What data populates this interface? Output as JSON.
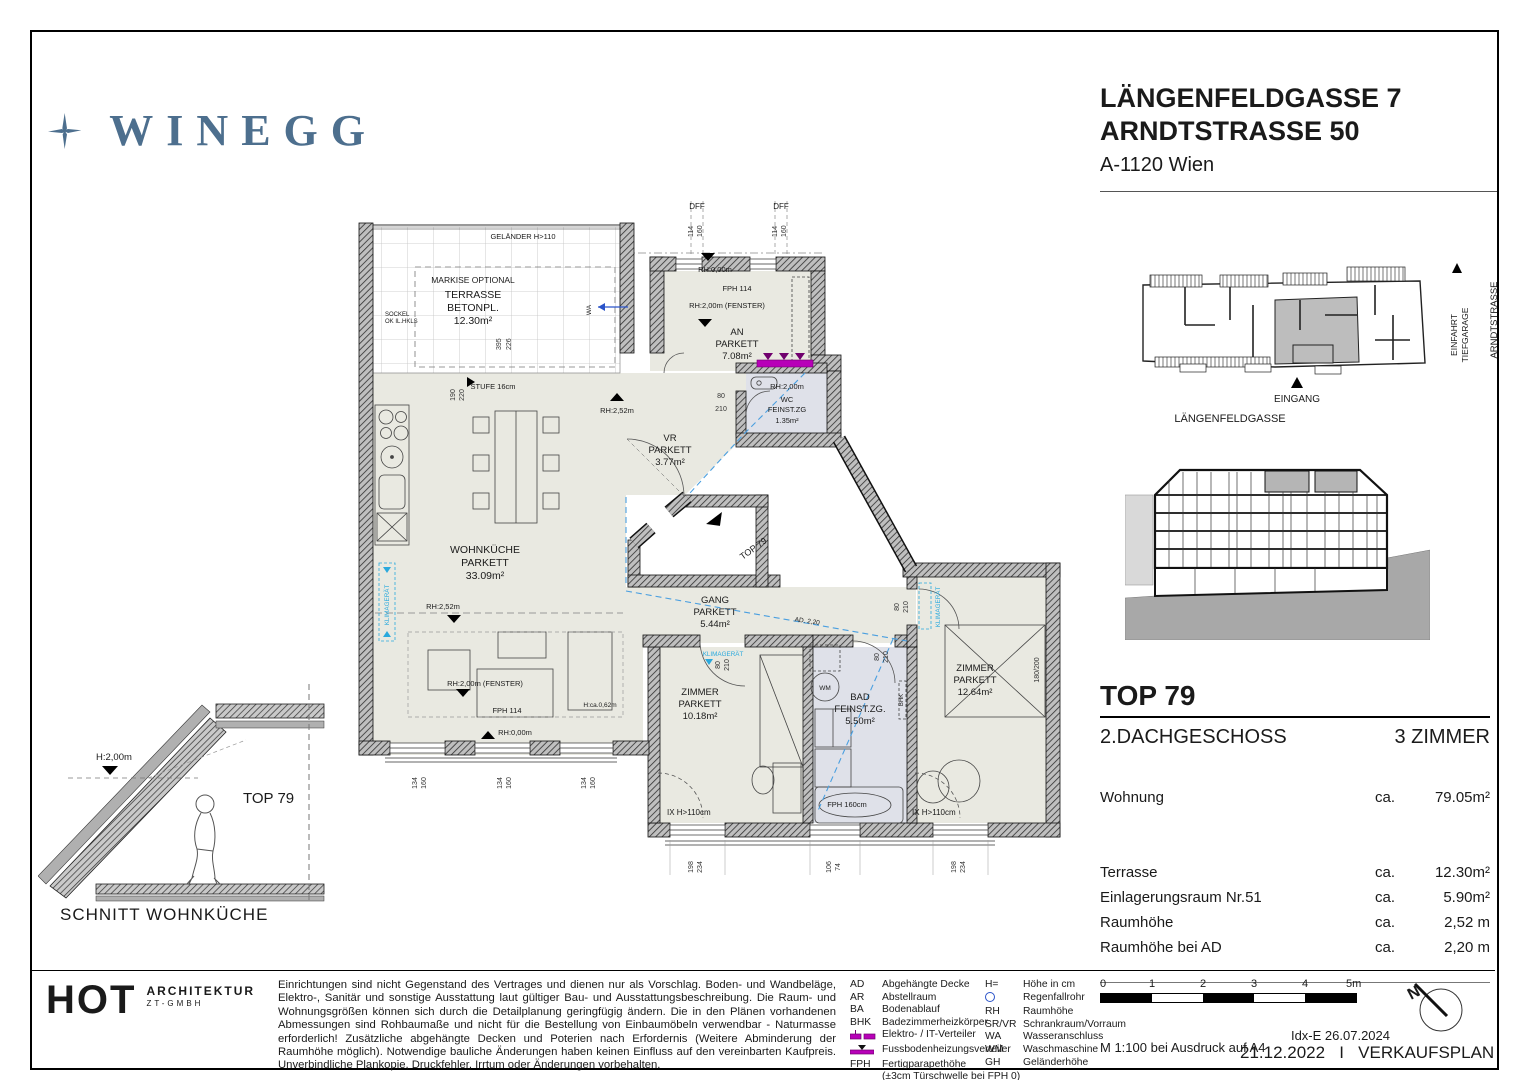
{
  "colors": {
    "brand": "#4d6f8e",
    "magenta": "#b800b8",
    "cyan": "#2aa9dd",
    "blue_dash": "#4a9fe0",
    "room": "#e9e9e1",
    "wet": "#dfe1e9",
    "wall_bg": "#bfbfbf",
    "grey": "#b0b0b0"
  },
  "brand": {
    "name": "WINEGG"
  },
  "address": {
    "line1": "LÄNGENFELDGASSE 7",
    "line2": "ARNDTSTRASSE 50",
    "city": "A-1120 Wien"
  },
  "site": {
    "eingang": "EINGANG",
    "street_bottom": "LÄNGENFELDGASSE",
    "einfahrt1": "EINFAHRT",
    "einfahrt2": "TIEFGARAGE",
    "street_right": "ARNDTSTRASSE"
  },
  "unit": {
    "top": "TOP 79",
    "floor": "2.DACHGESCHOSS",
    "rooms": "3 ZIMMER",
    "rows": [
      {
        "label": "Wohnung",
        "ca": "ca.",
        "value": "79.05m²"
      },
      {
        "label": "Terrasse",
        "ca": "ca.",
        "value": "12.30m²"
      },
      {
        "label": "Einlagerungsraum Nr.51",
        "ca": "ca.",
        "value": "5.90m²"
      },
      {
        "label": "Raumhöhe",
        "ca": "ca.",
        "value": "2,52 m"
      },
      {
        "label": "Raumhöhe bei AD",
        "ca": "ca.",
        "value": "2,20 m"
      }
    ]
  },
  "schnitt": {
    "h": "H:2,00m",
    "unit": "TOP 79",
    "caption": "SCHNITT WOHNKÜCHE"
  },
  "plan": {
    "gelaender": "GELÄNDER  H>110",
    "markise": "MARKISE  OPTIONAL",
    "terrasse1": "TERRASSE",
    "terrasse2": "BETONPL.",
    "terrasse3": "12.30m²",
    "sockel1": "SOCKEL",
    "sockel2": "OK  IL.HKLS",
    "stufe": "STUFE  16cm",
    "d190": "190",
    "d220": "220",
    "d395": "395",
    "d226": "226",
    "dff": "DFF",
    "d114": "114",
    "d160": "160",
    "rh000": "RH:0,00m",
    "fph114": "FPH  114",
    "rh200f": "RH:2,00m  (FENSTER)",
    "rh252": "RH:2,52m",
    "rh200": "RH:2,00m",
    "an1": "AN",
    "an2": "PARKETT",
    "an3": "7.08m²",
    "wa": "WA",
    "wc1": "WC",
    "wc2": "FEINST.ZG",
    "wc3": "1.35m²",
    "vr1": "VR",
    "vr2": "PARKETT",
    "vr3": "3.77m²",
    "top79": "TOP 79",
    "d80": "80",
    "d210": "210",
    "wk1": "WOHNKÜCHE",
    "wk2": "PARKETT",
    "wk3": "33.09m²",
    "gang1": "GANG",
    "gang2": "PARKETT",
    "gang3": "5.44m²",
    "ad220": "AD. 2,20",
    "klima": "KLIMAGERÄT",
    "z11": "ZIMMER",
    "z12": "PARKETT",
    "z13": "10.18m²",
    "bad1": "BAD",
    "bad2": "FEINST.ZG.",
    "bad3": "5.50m²",
    "wm": "WM",
    "bhk": "BHK",
    "fph160": "FPH  160cm",
    "z21": "ZIMMER",
    "z22": "PARKETT",
    "z23": "12.64m²",
    "d180200": "180/200",
    "hx": "IX  H>110cm",
    "d198": "198",
    "d234": "234",
    "d106": "106",
    "d74": "74",
    "d134": "134",
    "hca": "H:ca.0,62m"
  },
  "architect": {
    "logo": "HOT",
    "line1": "ARCHITEKTUR",
    "line2": "ZT-GMBH"
  },
  "disclaimer": "Einrichtungen sind nicht Gegenstand des Vertrages und dienen nur als Vorschlag. Boden- und Wandbeläge, Elektro-, Sanitär und sonstige Ausstattung laut gültiger Bau- und Ausstattungsbeschreibung. Die Raum- und Wohnungsgrößen können sich durch die Detailplanung geringfügig ändern. Die in den Plänen vorhandenen Abmessungen sind Rohbaumaße und nicht für die Bestellung von Einbaumöbeln verwendbar - Naturmasse erforderlich! Zusätzliche abgehängte Decken und Poterien nach Erfordernis (Weitere Abminderung der Raumhöhe möglich). Notwendige bauliche Änderungen haben keinen Einfluss auf den vereinbarten Kaufpreis. Unverbindliche Plankopie, Druckfehler, Irrtum oder Änderungen vorbehalten.",
  "legend": {
    "col1": [
      {
        "abbr": "AD",
        "desc": "Abgehängte Decke"
      },
      {
        "abbr": "AR",
        "desc": "Abstellraum"
      },
      {
        "abbr": "BA",
        "desc": "Bodenablauf"
      },
      {
        "abbr": "BHK",
        "desc": "Badezimmerheizkörper"
      },
      {
        "abbr": "",
        "desc": "Elektro- / IT-Verteiler",
        "icon": "elektro-it-verteiler"
      },
      {
        "abbr": "",
        "desc": "Fussbodenheizungsverteiler",
        "icon": "fussbodenheizungsverteiler"
      },
      {
        "abbr": "FPH",
        "desc": "Fertigparapethöhe"
      }
    ],
    "fph_note": "(±3cm Türschwelle bei FPH 0)",
    "col2": [
      {
        "abbr": "H=",
        "desc": "Höhe in cm"
      },
      {
        "abbr": "",
        "desc": "Regenfallrohr",
        "icon": "regenfallrohr"
      },
      {
        "abbr": "RH",
        "desc": "Raumhöhe"
      },
      {
        "abbr": "SR/VR",
        "desc": "Schrankraum/Vorraum"
      },
      {
        "abbr": "WA",
        "desc": "Wasseranschluss"
      },
      {
        "abbr": "WM",
        "desc": "Waschmaschine"
      },
      {
        "abbr": "GH",
        "desc": "Geländerhöhe"
      }
    ]
  },
  "scalebar": {
    "t0": "0",
    "t1": "1",
    "t2": "2",
    "t3": "3",
    "t4": "4",
    "t5": "5m",
    "note": "M 1:100 bei Ausdruck auf A4"
  },
  "titleblock": {
    "idx": "Idx-E 26.07.2024",
    "date": "21.12.2022",
    "sep": "I",
    "name": "VERKAUFSPLAN"
  },
  "north": {
    "n": "N"
  }
}
